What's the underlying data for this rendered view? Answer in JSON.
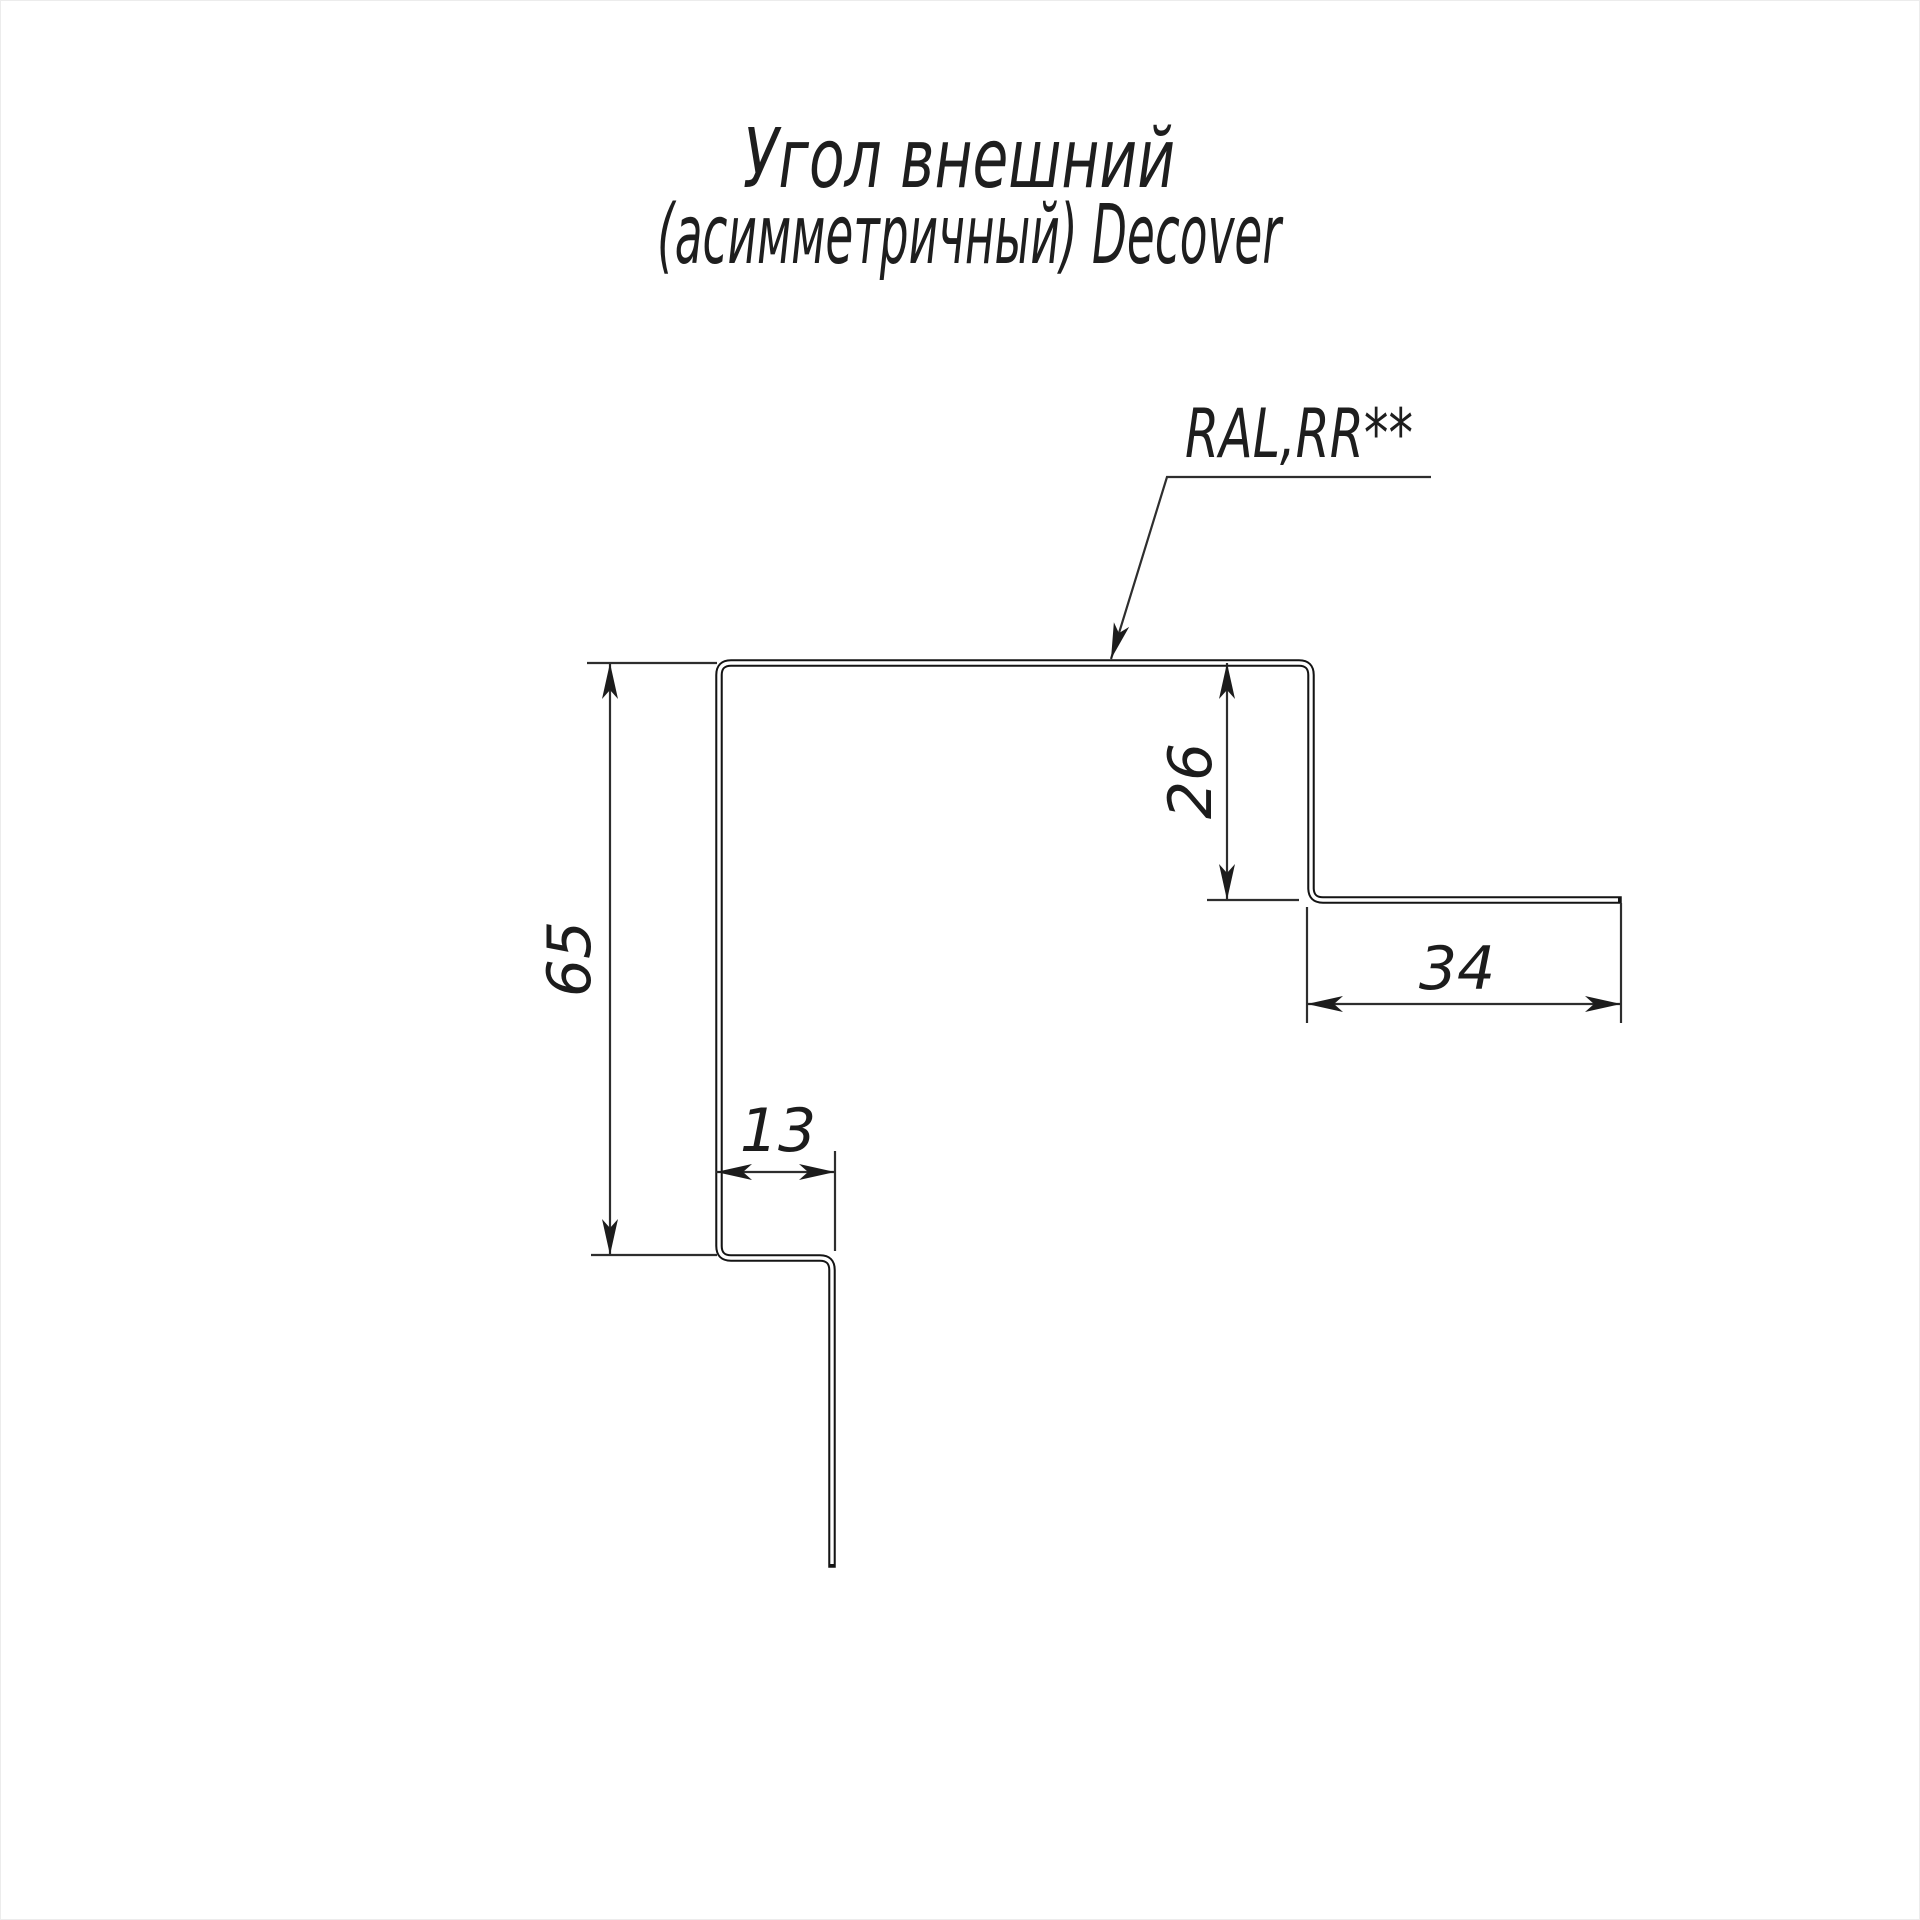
{
  "drawing": {
    "title_line1": "Угол внешний",
    "title_line2": "(асимметричный) Decover",
    "coating_label": "RAL,RR**",
    "dimensions": {
      "left_height": "65",
      "right_flange_depth": "26",
      "right_flange_width": "34",
      "bottom_lip_width": "13"
    },
    "colors": {
      "profile_line": "#141414",
      "dimension_line": "#2e2e2e",
      "text": "#1c1c1c",
      "background": "#ffffff"
    }
  }
}
